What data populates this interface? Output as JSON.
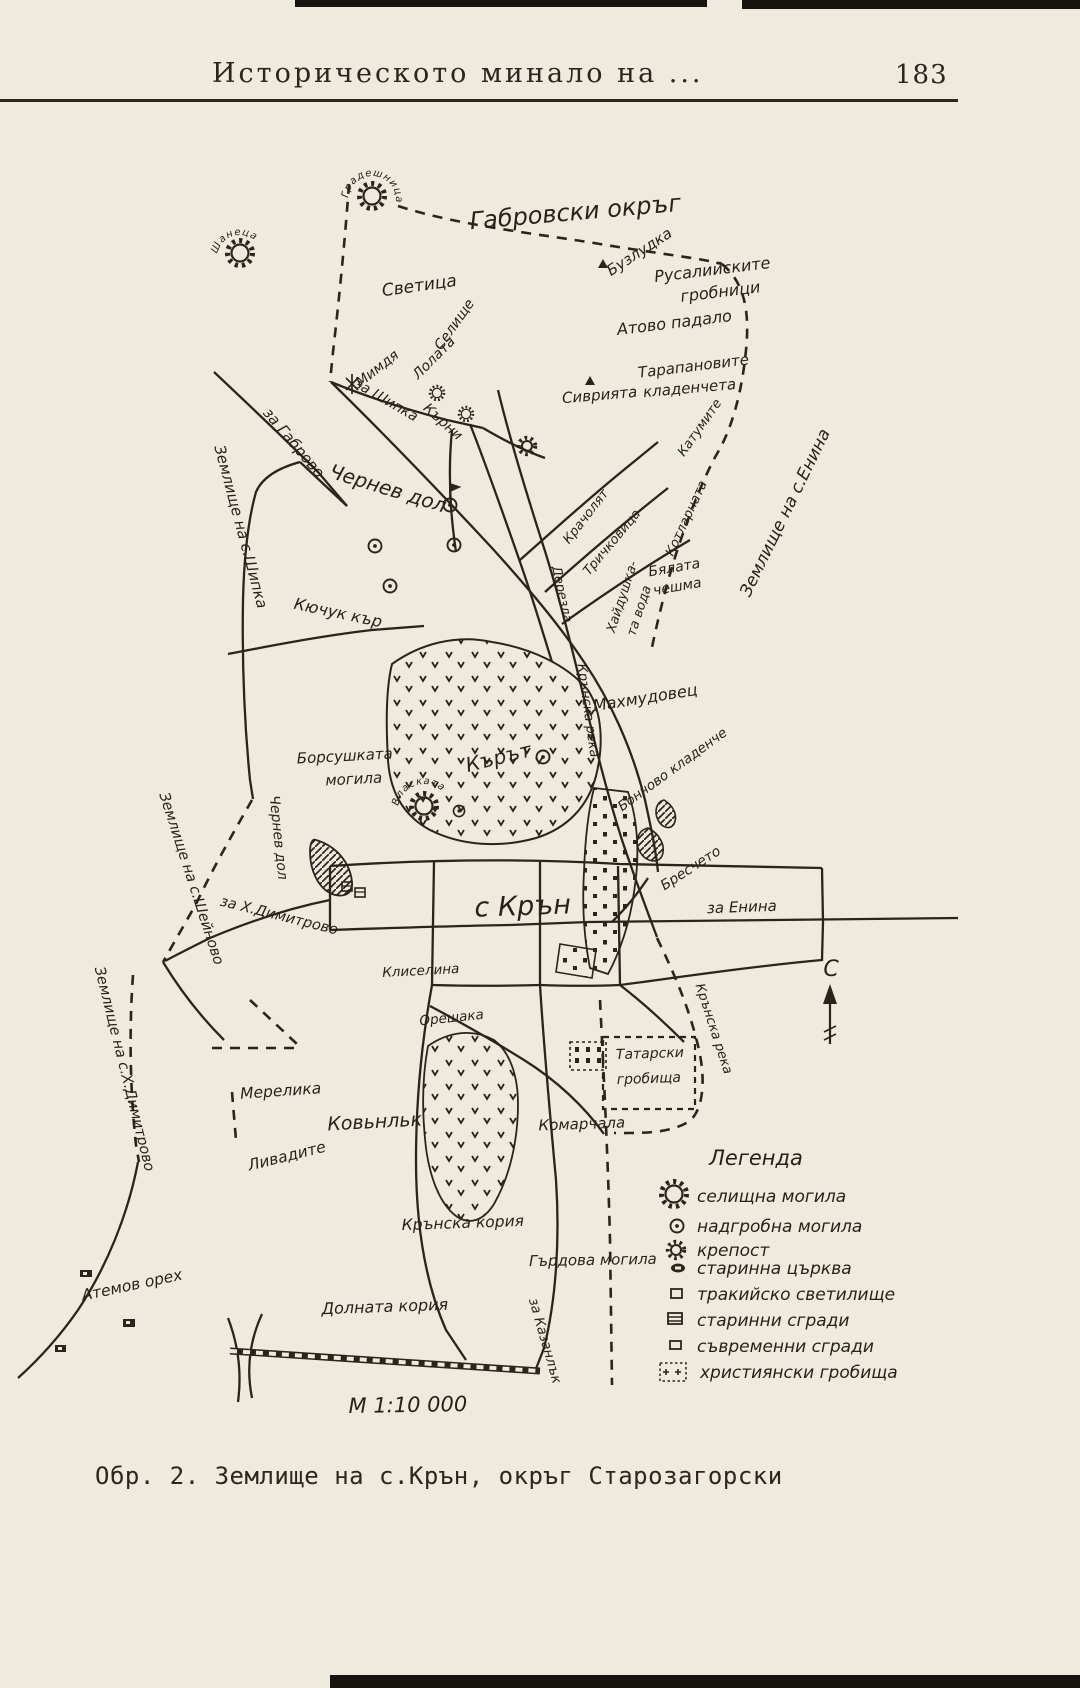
{
  "page": {
    "header": {
      "title": "Историческото минало на ...",
      "page_number": "183"
    },
    "caption": "Обр. 2. Землище на с.Крън, окръг Старозагорски",
    "colors": {
      "paper": "#eeeade",
      "ink": "#2a251c"
    }
  },
  "map": {
    "scale_text": "М 1:10 000",
    "compass_label": "С",
    "labels": [
      {
        "text": "Габровски окръг"
      },
      {
        "text": "Бузлудка"
      },
      {
        "text": "Русалийските"
      },
      {
        "text": "гробници"
      },
      {
        "text": "Светица"
      },
      {
        "text": "Селище"
      },
      {
        "text": "Мимдя"
      },
      {
        "text": "Лолата"
      },
      {
        "text": "Атово падало"
      },
      {
        "text": "Тарапановите"
      },
      {
        "text": "кладенчета"
      },
      {
        "text": "Сиврията"
      },
      {
        "text": "Катумите"
      },
      {
        "text": "за Габрово"
      },
      {
        "text": "Землище на с.Шипка"
      },
      {
        "text": "за Шипка"
      },
      {
        "text": "Кърни"
      },
      {
        "text": "Чернев дол"
      },
      {
        "text": "Кючук кър"
      },
      {
        "text": "Крачолят"
      },
      {
        "text": "Тричковица"
      },
      {
        "text": "Хайдушка-"
      },
      {
        "text": "та вода"
      },
      {
        "text": "Котларната"
      },
      {
        "text": "Бялата"
      },
      {
        "text": "чешма"
      },
      {
        "text": "Дерезла"
      },
      {
        "text": "Землище на с.Енина"
      },
      {
        "text": "Крънска река"
      },
      {
        "text": "Махмудовец"
      },
      {
        "text": "Кърът"
      },
      {
        "text": "Борсушката"
      },
      {
        "text": "могила"
      },
      {
        "text": "Власката"
      },
      {
        "text": "Бончово кладенче"
      },
      {
        "text": "Бресчето"
      },
      {
        "text": "за Енина"
      },
      {
        "text": "с Крън"
      },
      {
        "text": "за Х.Димитрово"
      },
      {
        "text": "Чернев дол"
      },
      {
        "text": "Землище на с.Шейново"
      },
      {
        "text": "Землище на с.Х.Димитрово"
      },
      {
        "text": "Клиселина"
      },
      {
        "text": "Орешака"
      },
      {
        "text": "Мерелика"
      },
      {
        "text": "Ковьнльк"
      },
      {
        "text": "Ливадите"
      },
      {
        "text": "Комарчала"
      },
      {
        "text": "Татарски"
      },
      {
        "text": "гробища"
      },
      {
        "text": "Крънска река"
      },
      {
        "text": "Крънска кория"
      },
      {
        "text": "Гърдова могила"
      },
      {
        "text": "Долната кория"
      },
      {
        "text": "Атемов орех"
      },
      {
        "text": "за Казанлък"
      },
      {
        "text": "Градешница"
      },
      {
        "text": "Шанеца"
      }
    ],
    "legend": {
      "title": "Легенда",
      "items": [
        {
          "symbol": "settlement-mound-icon",
          "label": "селищна могила"
        },
        {
          "symbol": "burial-mound-icon",
          "label": "надгробна могила"
        },
        {
          "symbol": "fortress-icon",
          "label": "крепост"
        },
        {
          "symbol": "old-church-icon",
          "label": "старинна църква"
        },
        {
          "symbol": "thracian-sanctuary-icon",
          "label": "тракийско светилище"
        },
        {
          "symbol": "old-buildings-icon",
          "label": "старинни сгради"
        },
        {
          "symbol": "modern-buildings-icon",
          "label": "съвременни сгради"
        },
        {
          "symbol": "christian-cemetery-icon",
          "label": "християнски гробища"
        }
      ]
    }
  }
}
